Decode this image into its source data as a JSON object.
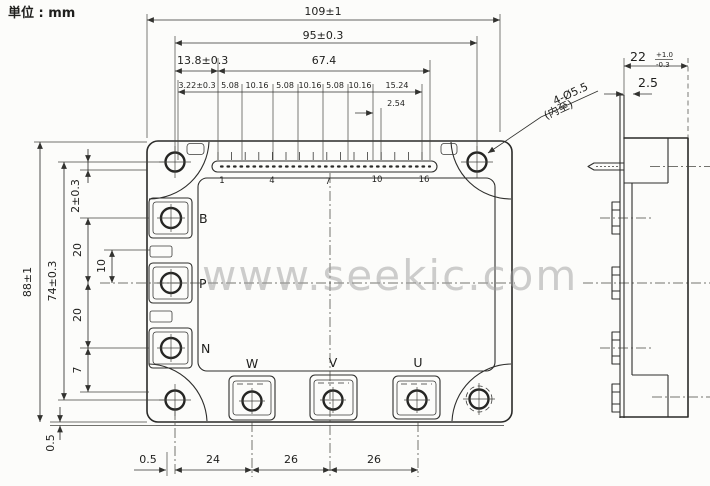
{
  "unit_label": "単位 : mm",
  "watermark": "www.seekic.com",
  "front": {
    "dims_top": {
      "overall": "109±1",
      "hole_span": "95±0.3",
      "hole_to_pin1": "13.8±0.3",
      "pin_span": "67.4",
      "pitch": [
        "3.22±0.3",
        "5.08",
        "10.16",
        "5.08",
        "10.16",
        "5.08",
        "10.16",
        "15.24"
      ],
      "pitch_small": "2.54"
    },
    "dims_left": {
      "overall": "88±1",
      "hole_span": "74±0.3",
      "top_offset": "2±0.3",
      "pitch_upper": "20",
      "tab": "10",
      "pitch_lower": "20",
      "bottom_offset": "7",
      "base": "0.5"
    },
    "dims_bottom": {
      "edge": "0.5",
      "d1": "24",
      "d2": "26",
      "d3": "26"
    },
    "pins": [
      "1",
      "4",
      "7",
      "10",
      "16"
    ],
    "terminals_left": [
      "B",
      "P",
      "N"
    ],
    "terminals_bottom": [
      "W",
      "V",
      "U"
    ],
    "hole_note": {
      "line1": "4-Ø5.5",
      "line2": "(内至)"
    }
  },
  "side": {
    "overall": "22",
    "tol_plus": "+1.0",
    "tol_minus": "-0.3",
    "edge": "2.5"
  },
  "colors": {
    "ink": "#2a2a28",
    "paper": "#fcfcfa",
    "watermark": "#9e9e9e"
  }
}
